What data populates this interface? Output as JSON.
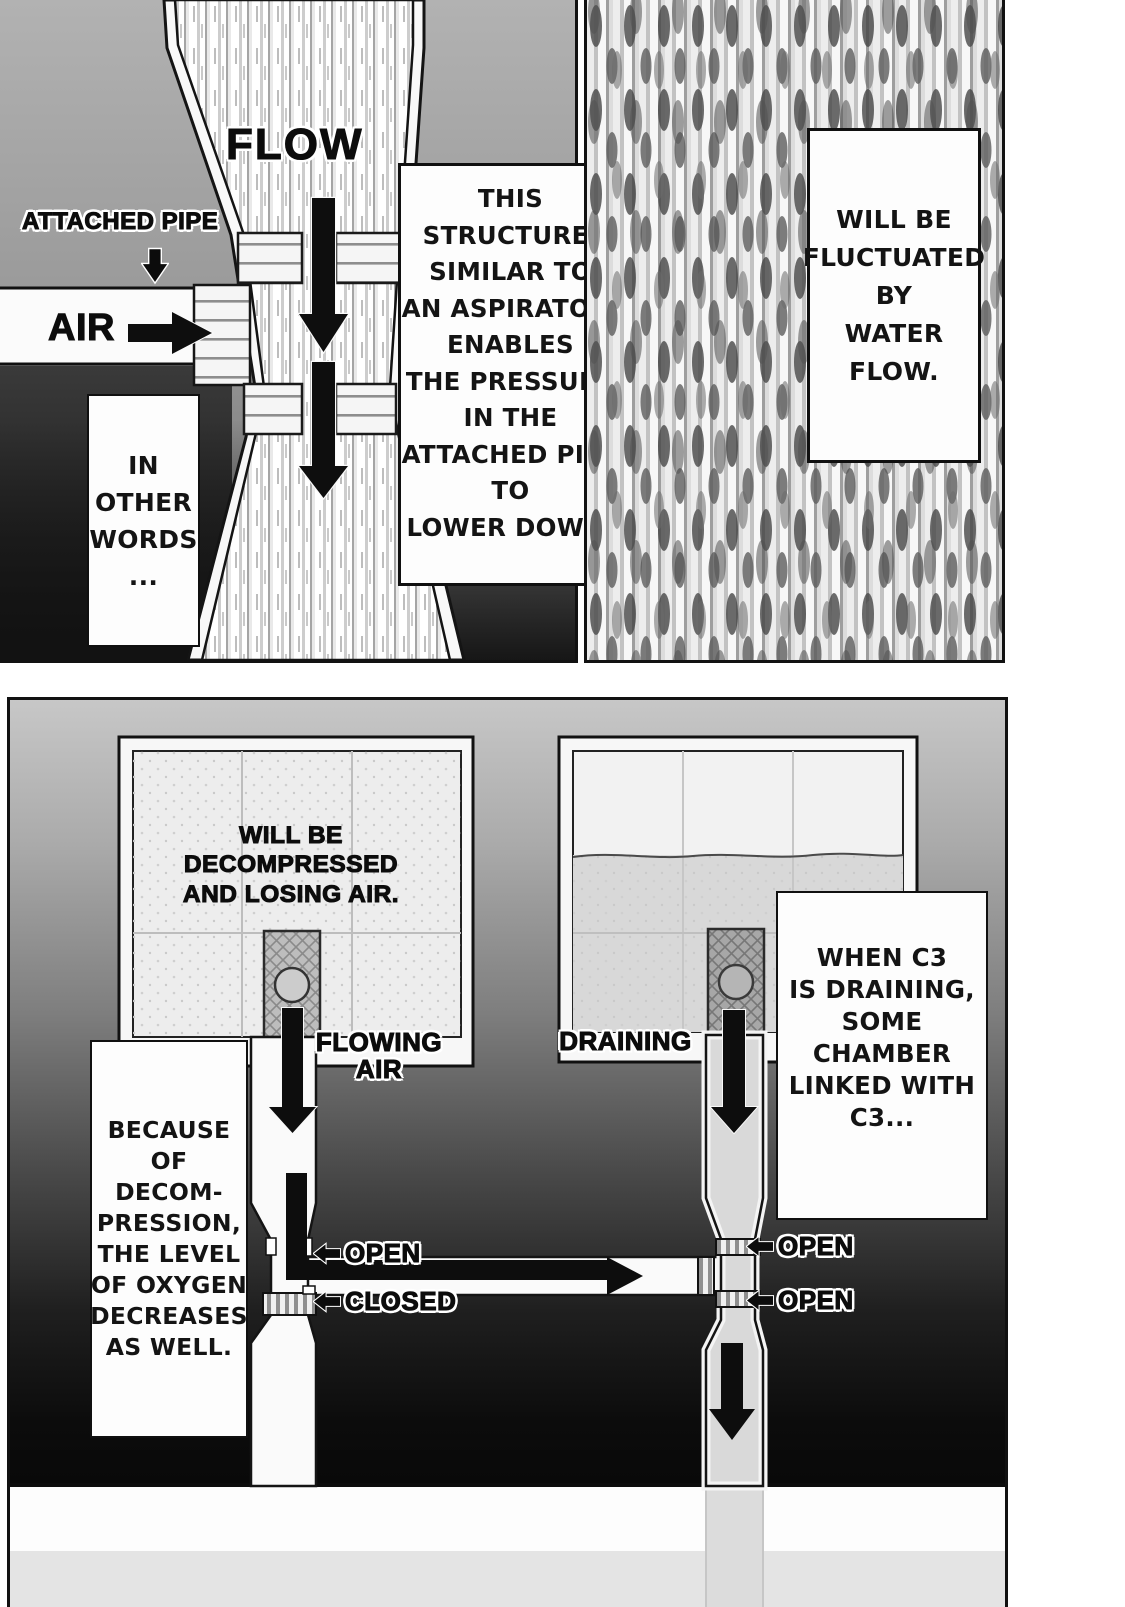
{
  "colors": {
    "ink": "#111111",
    "paper": "#ffffff",
    "panel_light_gray": "#c6c6c6",
    "panel_dark_gray": "#0a0a0a",
    "water_gray": "#d8d8d8"
  },
  "top_left_panel": {
    "flow_label": "FLOW",
    "attached_pipe_label": "ATTACHED PIPE",
    "air_label": "AIR",
    "note_in_other_words": "IN\nOTHER\nWORDS\n...",
    "note_aspirator": "THIS\nSTRUCTURE,\nSIMILAR TO\nAN ASPIRATOR,\nENABLES\nTHE PRESSURE\nIN THE\nATTACHED PIPE\nTO\nLOWER DOWN."
  },
  "top_right_panel": {
    "note_fluctuated": "WILL BE\nFLUCTUATED\nBY\nWATER\nFLOW."
  },
  "bottom_panel": {
    "left_chamber_caption": "WILL BE\nDECOMPRESSED\nAND LOSING AIR.",
    "flowing_air_label": "FLOWING\nAIR",
    "draining_label": "DRAINING",
    "note_because": "BECAUSE OF\nDECOM-\nPRESSION,\nTHE LEVEL\nOF OXYGEN\nDECREASES\nAS WELL.",
    "note_when_c3": "WHEN C3\nIS DRAINING,\nSOME CHAMBER\nLINKED WITH\nC3...",
    "valve_left_top_label": "OPEN",
    "valve_left_bottom_label": "CLOSED",
    "valve_right_top_label": "OPEN",
    "valve_right_bottom_label": "OPEN"
  }
}
